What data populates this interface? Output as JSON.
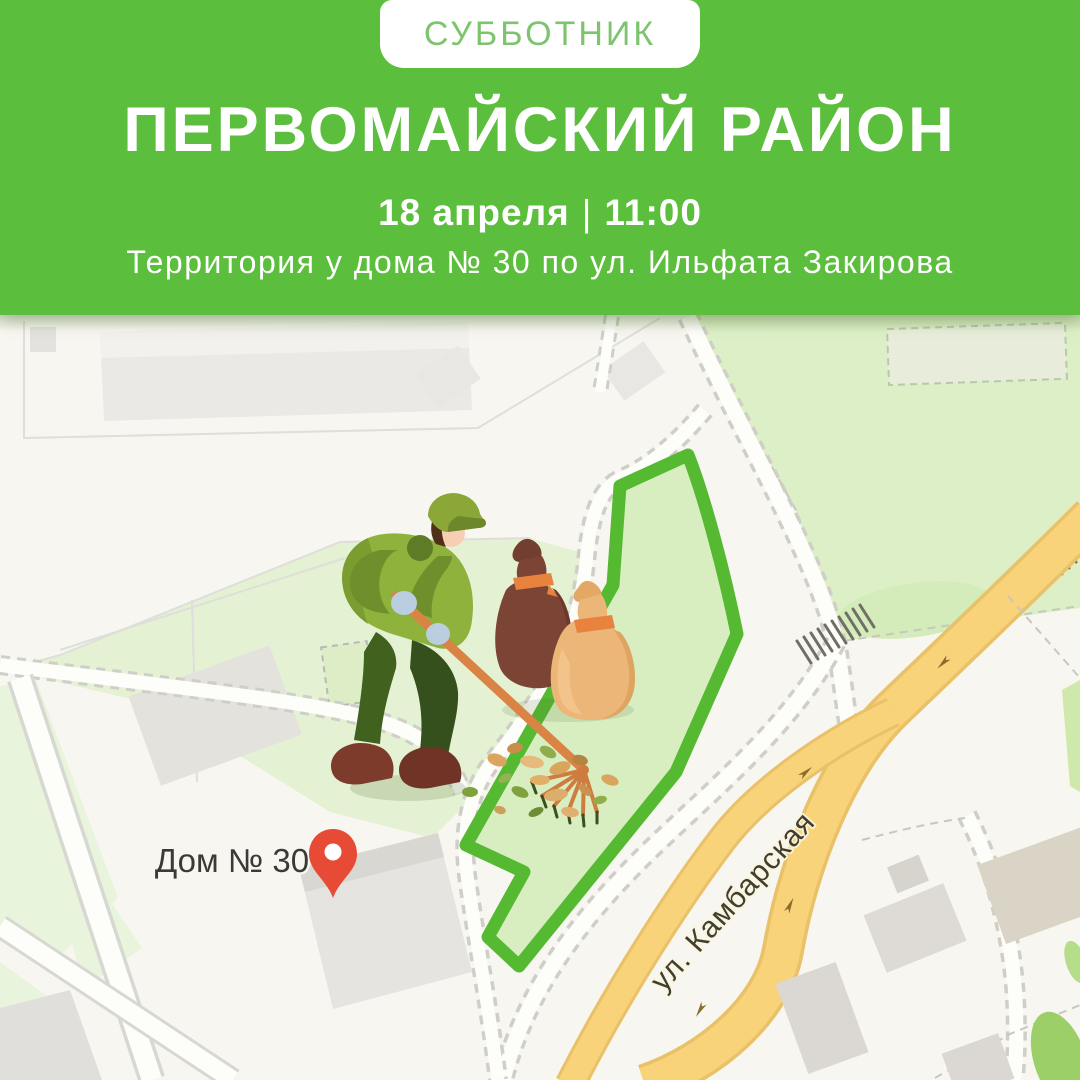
{
  "badge": {
    "label": "СУББОТНИК"
  },
  "header": {
    "title": "ПЕРВОМАЙСКИЙ РАЙОН",
    "date": "18 апреля",
    "separator": "|",
    "time": "11:00",
    "address": "Территория у дома № 30 по ул. Ильфата Закирова"
  },
  "map": {
    "labels": {
      "house": "Дом № 30",
      "street": "ул. Камбарская"
    },
    "icons": {
      "pin": "location-pin",
      "illustration": "worker-raking-leaves-with-trash-bags"
    },
    "colors": {
      "header_green": "#5cbe3d",
      "badge_text_green": "#7cc46e",
      "area_outline_green": "#55b932",
      "area_fill_green": "#d8eec1",
      "road_yellow": "#f8d071",
      "park_green": "#dcefc6",
      "pin_red": "#e84b35",
      "map_background": "#f7f6f0"
    }
  }
}
